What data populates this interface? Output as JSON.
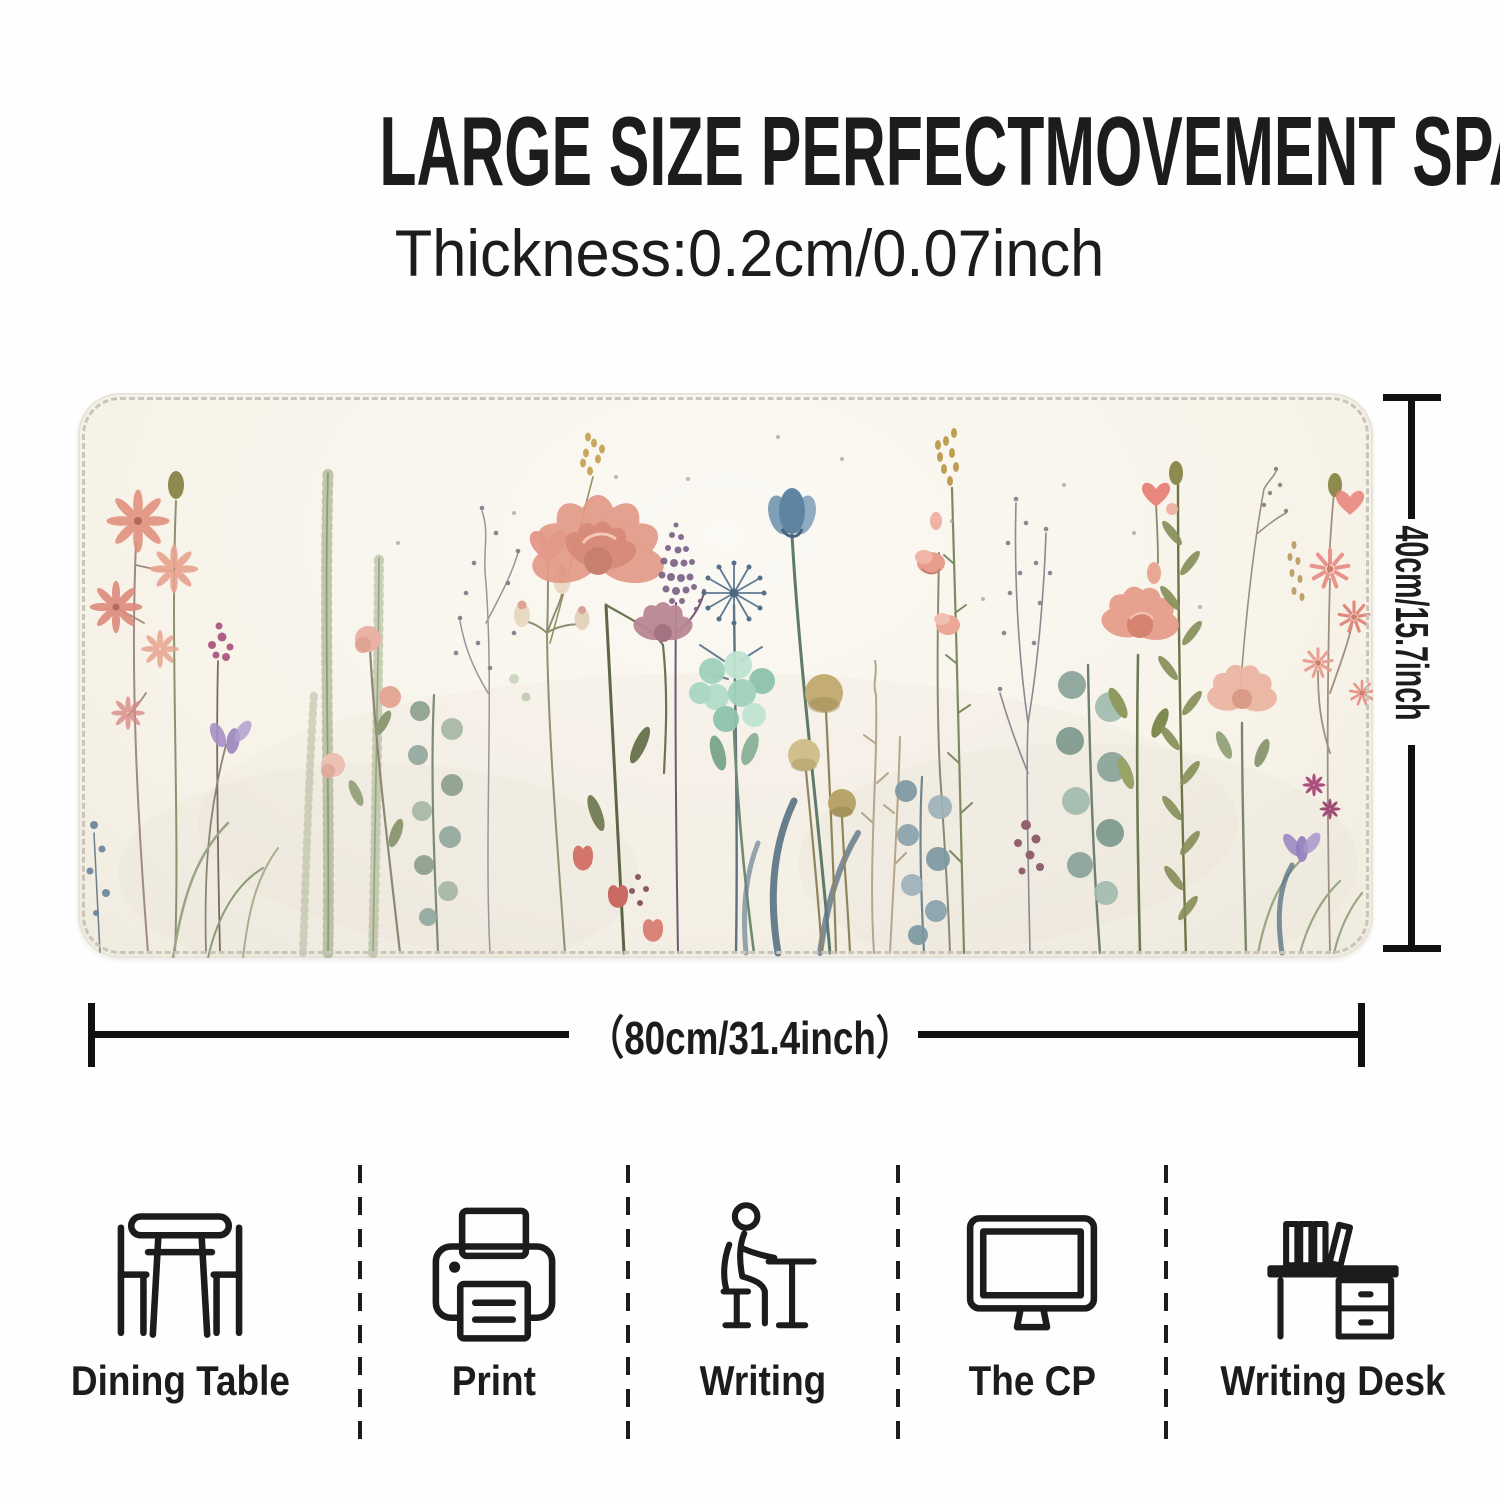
{
  "header": {
    "title": "LARGE SIZE PERFECTMOVEMENT SPACE",
    "subtitle": "Thickness:0.2cm/0.07inch"
  },
  "product": {
    "name": "watercolor-wildflower-desk-mat",
    "width_label": "（80cm/31.4inch）",
    "height_label": "40cm/15.7inch"
  },
  "palette": {
    "text": "#1c1c1c",
    "dimension_lines": "#111111",
    "page_background": "#fefefe",
    "pad_background": "#f7f3e9",
    "stitch": "#c9c5bb",
    "coral": "#e2917f",
    "blush_peony": "#e39a87",
    "mauve": "#b98794",
    "slate_blue": "#5f84a2",
    "mint": "#9fd2bd",
    "sage": "#98a682",
    "olive_tan": "#c3ad74",
    "plum": "#7a5f86",
    "magenta": "#ad4f7d",
    "lavender": "#a58fc4",
    "berry": "#915f6d",
    "gold": "#c4a04f"
  },
  "use_cases": {
    "items": [
      {
        "icon": "dining-table-icon",
        "label": "Dining Table"
      },
      {
        "icon": "printer-icon",
        "label": "Print"
      },
      {
        "icon": "writing-icon",
        "label": "Writing"
      },
      {
        "icon": "monitor-icon",
        "label": "The CP"
      },
      {
        "icon": "writing-desk-icon",
        "label": "Writing Desk"
      }
    ]
  }
}
